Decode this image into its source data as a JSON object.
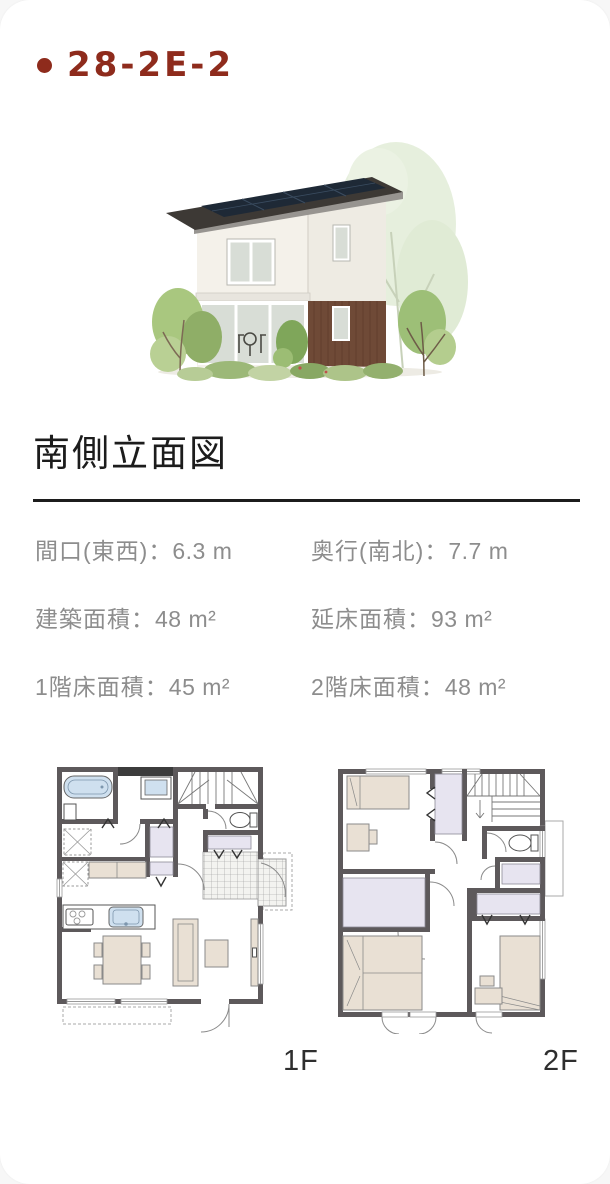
{
  "page": {
    "title": "28-2E-2"
  },
  "elevation": {
    "heading": "南側立面図"
  },
  "house_illustration": {
    "alt": "二階建て住宅の外観パース（太陽光パネル付き屋根・白壁・木目サイディング・植栽）"
  },
  "specs": {
    "separator": "：",
    "rows": [
      [
        {
          "label": "間口(東西)",
          "value": "6.3 m"
        },
        {
          "label": "奥行(南北)",
          "value": "7.7 m"
        }
      ],
      [
        {
          "label": "建築面積",
          "value": "48 m²"
        },
        {
          "label": "延床面積",
          "value": "93 m²"
        }
      ],
      [
        {
          "label": "1階床面積",
          "value": "45 m²"
        },
        {
          "label": "2階床面積",
          "value": "48 m²"
        }
      ]
    ]
  },
  "floor_plans": {
    "first_label": "1F",
    "second_label": "2F"
  },
  "colors": {
    "accent": "#8e2b1c",
    "ink": "#1c1c1c",
    "gray": "#8d8d8d",
    "label": "#2e2e2e",
    "wall": "#5d595b",
    "lav": "#e7e4f0",
    "beige": "#e9e0d4",
    "blue": "#cfe0ef",
    "roof": "#3d3935",
    "solar": "#1e2936",
    "wood": "#6f4a37",
    "cream": "#f4f1ea",
    "glass": "#d8ddd6",
    "line": "#1c1c1c"
  }
}
